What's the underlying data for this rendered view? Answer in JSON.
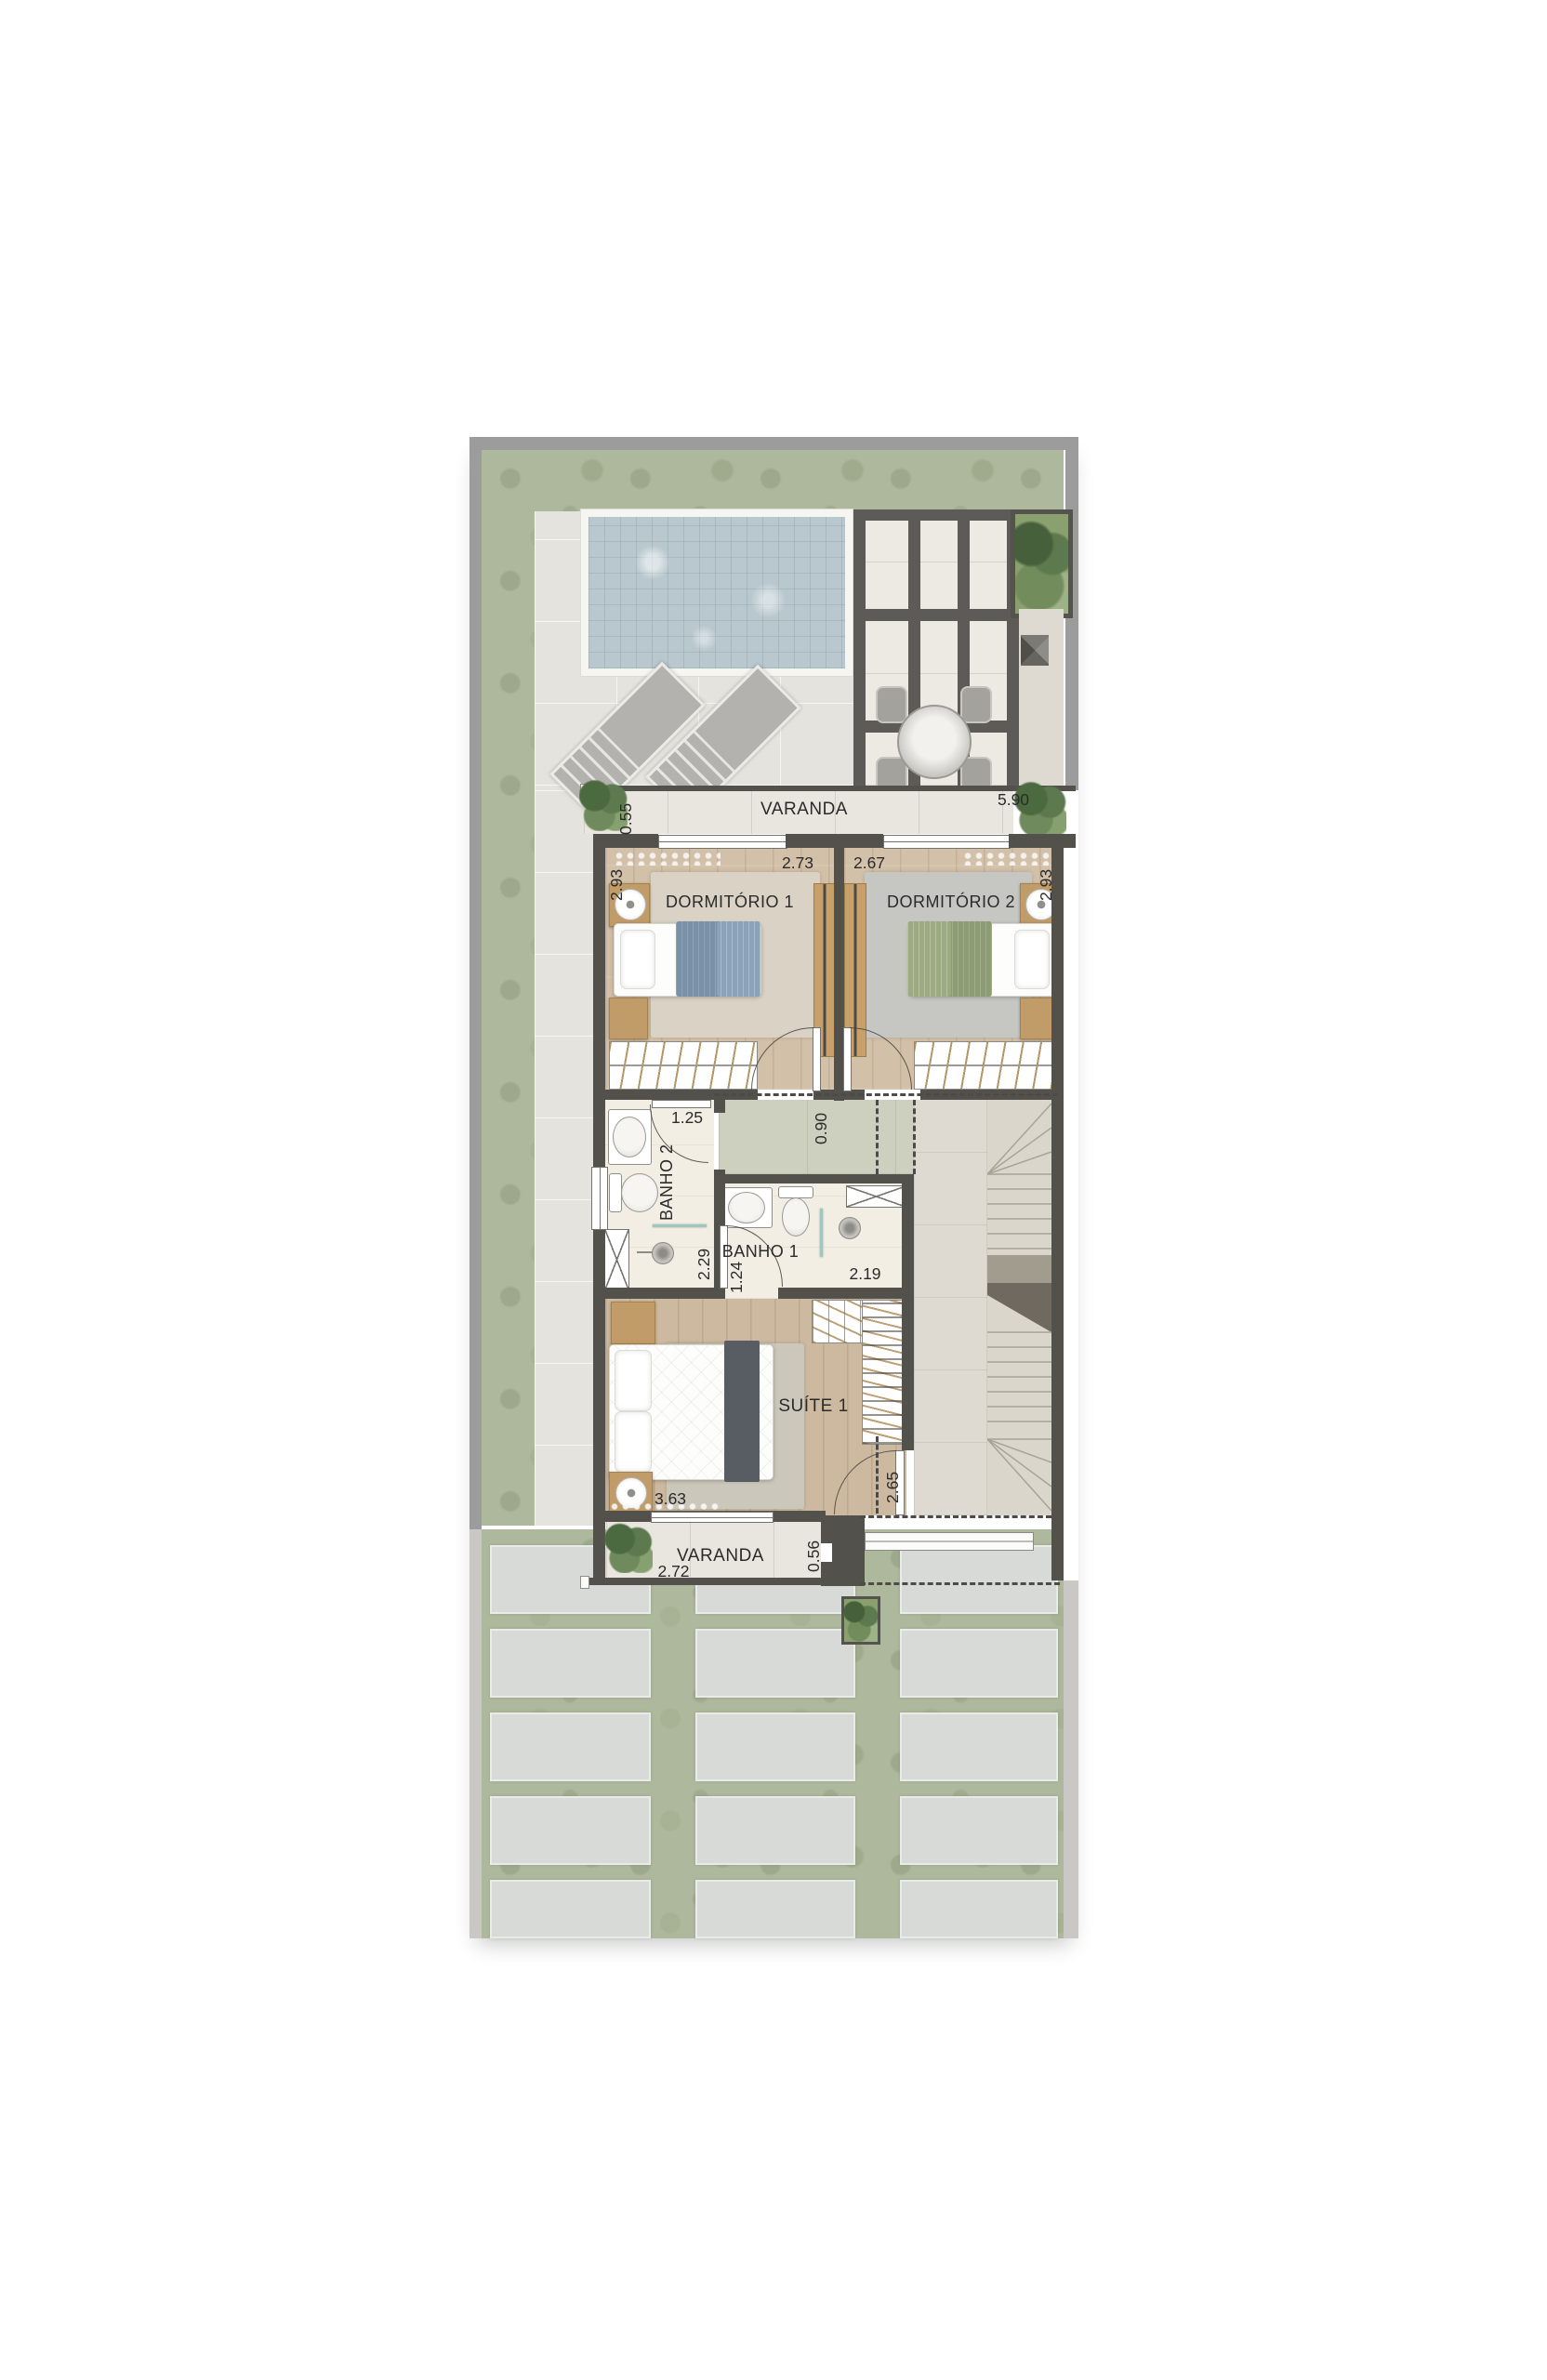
{
  "document": {
    "kind": "residential floor plan render",
    "language": "pt-BR"
  },
  "rooms": {
    "varanda_top": {
      "label": "VARANDA",
      "dim_width": "5.90",
      "dim_depth": "0.55"
    },
    "dormitorio_1": {
      "label": "DORMITÓRIO 1",
      "dim_width": "2.73",
      "dim_depth": "2.93"
    },
    "dormitorio_2": {
      "label": "DORMITÓRIO 2",
      "dim_width": "2.67",
      "dim_depth": "2.93"
    },
    "hall": {
      "dim_width": "0.90"
    },
    "banho_2": {
      "label": "BANHO 2",
      "dim_width": "1.25",
      "dim_depth": "2.29"
    },
    "banho_1": {
      "label": "BANHO 1",
      "dim_width": "1.24",
      "dim_depth": "2.19"
    },
    "suite_1": {
      "label": "SUÍTE 1",
      "dim_width": "3.63",
      "dim_depth": "2.65"
    },
    "varanda_bottom": {
      "label": "VARANDA",
      "dim_width": "2.72",
      "dim_depth": "0.56"
    }
  },
  "colors": {
    "unit_wall": "#53514c",
    "boundary_wall": "#9c9c9c",
    "grass": "#aeb89d",
    "pool_water": "#b9c8ce",
    "wood_floor": "#d2c0a8",
    "bath_floor": "#f3eee4",
    "hall_floor": "#cdd0bf",
    "paver": "#d7dad6",
    "label_text": "#2b2b2b"
  }
}
